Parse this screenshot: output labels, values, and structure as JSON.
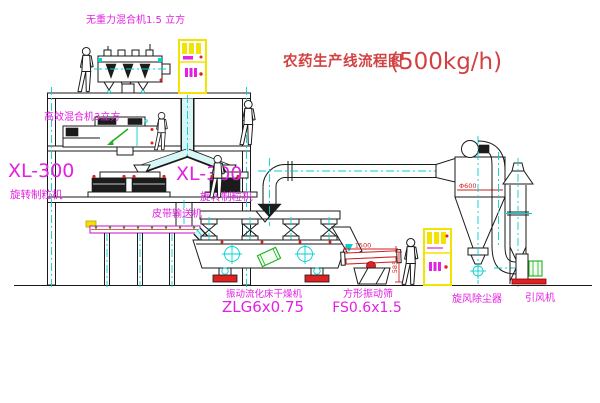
{
  "title": {
    "text": "农药生产线流程图",
    "capacity": "(500kg/h)"
  },
  "equipment_labels": {
    "gravity_free_mixer": "无重力混合机1.5 立方",
    "high_efficiency_mixer": "高效混合机3立方",
    "granulator_left": {
      "model": "XL-300",
      "name": "旋转制粒机"
    },
    "granulator_center": {
      "model": "XL-300",
      "name": "旋转制粒机"
    },
    "belt_conveyor": "皮带输送机",
    "fluid_bed_dryer": {
      "name": "振动流化床干燥机",
      "model": "ZLG6x0.75"
    },
    "vibrating_screen": {
      "name": "方形振动筛",
      "model": "FS0.6x1.5"
    },
    "cyclone_dust_collector": "旋风除尘器",
    "induced_draft_fan": "引风机"
  },
  "dimensions": {
    "screen_length": "1500",
    "screen_outlet_height": "585",
    "cyclone_diameter": "Φ600"
  },
  "colors": {
    "label_magenta": "#e321e3",
    "title_red": "#d24242",
    "dimension_red": "#cc2222",
    "centerline_cyan": "#00d2d2",
    "cabinet_yellow": "#f2e400",
    "machine_green": "#1faf1f",
    "accent_red": "#e02020",
    "line_black": "#1a1a1a"
  }
}
